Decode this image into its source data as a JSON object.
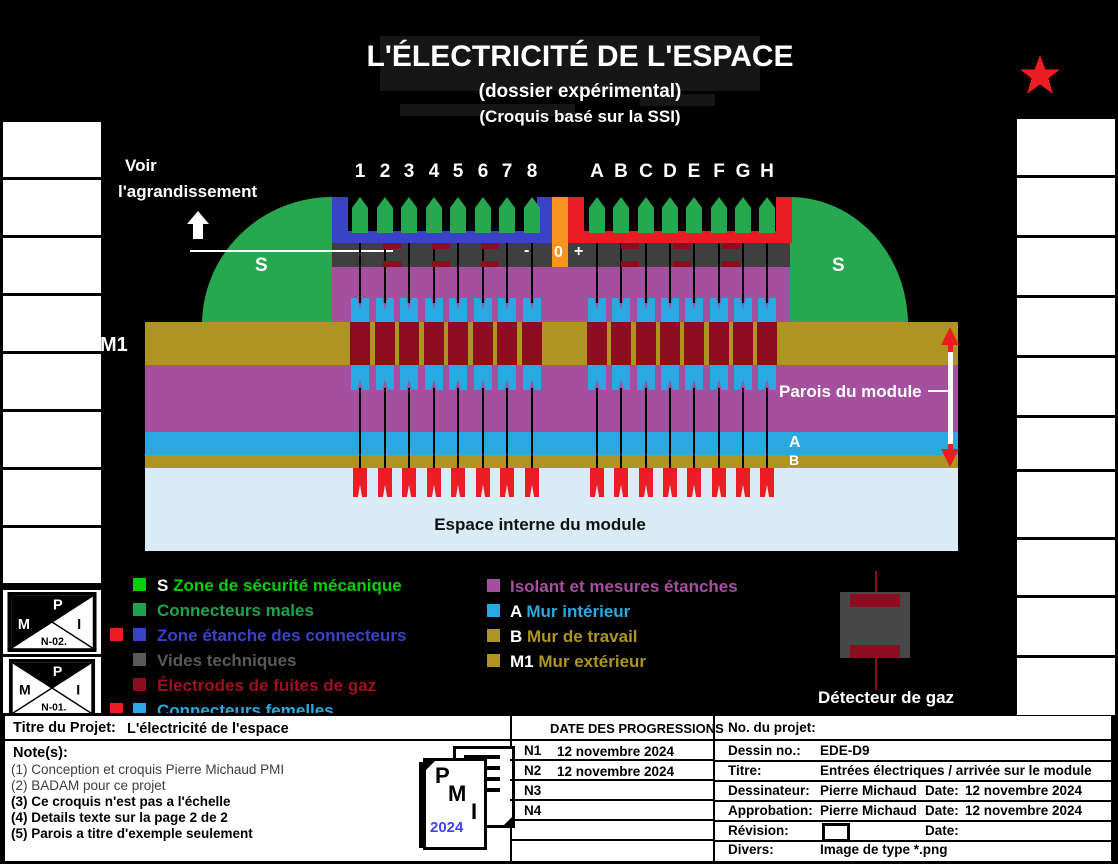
{
  "header": {
    "title": "L'ÉLECTRICITÉ DE L'ESPACE",
    "subtitle1": "(dossier expérimental)",
    "subtitle2": "(Croquis basé sur la SSI)"
  },
  "diagram": {
    "see_line1": "Voir",
    "see_line2": "l'agrandissement",
    "pins_left": [
      "1",
      "2",
      "3",
      "4",
      "5",
      "6",
      "7",
      "8"
    ],
    "pins_right": [
      "A",
      "B",
      "C",
      "D",
      "E",
      "F",
      "G",
      "H"
    ],
    "minus": "-",
    "zero": "0",
    "plus": "+",
    "s_label": "S",
    "m1_label": "M1",
    "a_label": "A",
    "b_label": "B",
    "walls_label": "Parois du module",
    "inner_space_label": "Espace interne du module"
  },
  "legend": {
    "left": [
      {
        "bullet": "#00d000",
        "prefix": "S",
        "prefix_color": "#ffffff",
        "label": "Zone de sécurité mécanique",
        "color": "#00d000",
        "extra_bullet": false
      },
      {
        "bullet": "#21a14d",
        "prefix": "",
        "prefix_color": "",
        "label": "Connecteurs males",
        "color": "#21a14d",
        "extra_bullet": false
      },
      {
        "bullet": "#3a43c6",
        "prefix": "",
        "prefix_color": "",
        "label": "Zone étanche des connecteurs",
        "color": "#3a43c6",
        "extra_bullet": true
      },
      {
        "bullet": "#595959",
        "prefix": "",
        "prefix_color": "",
        "label": "Vides techniques",
        "color": "#595959",
        "extra_bullet": false
      },
      {
        "bullet": "#8d0c20",
        "prefix": "",
        "prefix_color": "",
        "label": "Électrodes de fuites de gaz",
        "color": "#a00f1e",
        "extra_bullet": false
      },
      {
        "bullet": "#29a9e1",
        "prefix": "",
        "prefix_color": "",
        "label": "Connecteurs femelles",
        "color": "#29a9e1",
        "extra_bullet": true
      }
    ],
    "right": [
      {
        "bullet": "#a4509e",
        "prefix": "",
        "prefix_color": "",
        "label": "Isolant et mesures étanches",
        "color": "#a4509e",
        "extra_bullet": false
      },
      {
        "bullet": "#29a9e1",
        "prefix": "A",
        "prefix_color": "#ffffff",
        "label": "Mur intérieur",
        "color": "#29a9e1",
        "extra_bullet": false
      },
      {
        "bullet": "#ae9420",
        "prefix": "B",
        "prefix_color": "#ffffff",
        "label": "Mur de travail",
        "color": "#ae9420",
        "extra_bullet": false
      },
      {
        "bullet": "#ae9420",
        "prefix": "M1",
        "prefix_color": "#ffffff",
        "label": "Mur extérieur",
        "color": "#ae9420",
        "extra_bullet": false
      }
    ]
  },
  "detector": {
    "label": "Détecteur de gaz"
  },
  "logos": {
    "n02": {
      "p": "P",
      "m": "M",
      "i": "I",
      "n": "N-02."
    },
    "n01": {
      "p": "P",
      "m": "M",
      "i": "I",
      "n": "N-01."
    },
    "pmi": {
      "p": "P",
      "m": "M",
      "i": "I",
      "year": "2024"
    }
  },
  "titleblock": {
    "project_label": "Titre du Projet:",
    "project_value": "L'électricité de l'espace",
    "notes_label": "Note(s):",
    "notes": [
      {
        "text": "(1) Conception et croquis Pierre Michaud PMI",
        "bold": false
      },
      {
        "text": "(2) BADAM pour ce projet",
        "bold": false
      },
      {
        "text": "(3) Ce croquis n'est pas a l'échelle",
        "bold": true
      },
      {
        "text": "(4) Details texte sur la page 2 de 2",
        "bold": true
      },
      {
        "text": "(5) Parois a titre d'exemple seulement",
        "bold": true
      }
    ],
    "progress_header": "DATE DES PROGRESSIONS",
    "progress_rows": [
      {
        "n": "N1",
        "date": "12 novembre 2024"
      },
      {
        "n": "N2",
        "date": "12 novembre 2024"
      },
      {
        "n": "N3",
        "date": ""
      },
      {
        "n": "N4",
        "date": ""
      },
      {
        "n": "",
        "date": ""
      },
      {
        "n": "",
        "date": ""
      }
    ],
    "fields": {
      "no_projet_label": "No. du projet:",
      "no_projet_value": "",
      "dessin_label": "Dessin no.:",
      "dessin_value": "EDE-D9",
      "titre_label": "Titre:",
      "titre_value": "Entrées électriques / arrivée sur le module",
      "dessinateur_label": "Dessinateur:",
      "dessinateur_value": "Pierre Michaud",
      "dessinateur_date_label": "Date:",
      "dessinateur_date": "12 novembre 2024",
      "approbation_label": "Approbation:",
      "approbation_value": "Pierre Michaud",
      "approbation_date_label": "Date:",
      "approbation_date": "12 novembre 2024",
      "revision_label": "Révision:",
      "revision_date_label": "Date:",
      "divers_label": "Divers:",
      "divers_value": "Image de type *.png"
    }
  },
  "colors": {
    "bright_green": "#00d000",
    "green": "#28a751",
    "blue_zone": "#3a43c6",
    "orange": "#f7941e",
    "red": "#ec1c24",
    "dark_gray_band": "#3f3f3f",
    "legend_gray": "#595959",
    "purple": "#a4509e",
    "olive": "#ae9420",
    "dark_red": "#8d0c20",
    "cyan": "#29a9e1",
    "light_blue": "#d9ecf6",
    "detector_gray": "#474747"
  }
}
